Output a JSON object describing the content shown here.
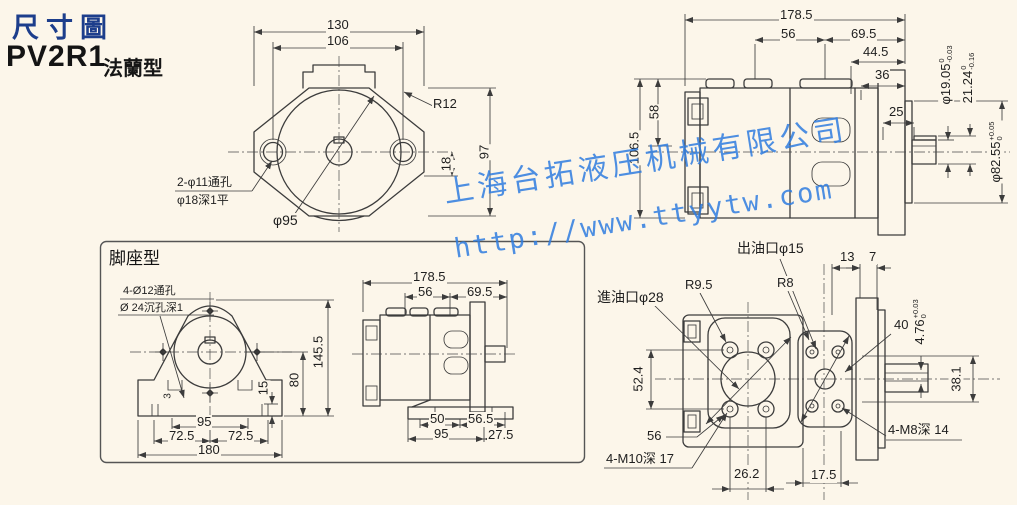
{
  "header": {
    "title": "尺寸圖",
    "model": "PV2R1",
    "variant": "法蘭型"
  },
  "watermark": {
    "company": "上海台拓液压机械有限公司",
    "url": "http://www.ttyytw.com",
    "color": "#2f7de0"
  },
  "colors": {
    "accent_navy": "#1d3e8c",
    "watermark_blue": "#2f7de0",
    "line": "#3c3c3c",
    "background": "#fcf6ea"
  },
  "flange_front": {
    "d130": "130",
    "d106": "106",
    "r12": "R12",
    "d97": "97",
    "d18": "18",
    "note1": "2-φ11通孔",
    "note2": "φ18深1平",
    "d95": "φ95"
  },
  "flange_side": {
    "d178": "178.5",
    "d56": "56",
    "d69": "69.5",
    "d44": "44.5",
    "d36": "36",
    "d25": "25",
    "d106": "106.5",
    "d58": "58",
    "shaft": {
      "v": "φ19.05",
      "t": "0",
      "b": "-0.03"
    },
    "key": {
      "v": "21.24",
      "t": "0",
      "b": "-0.16"
    },
    "spigot": {
      "v": "φ82.55",
      "t": "+0.05",
      "b": "0"
    }
  },
  "foot": {
    "label": "脚座型",
    "front": {
      "note1": "4-Ø12通孔",
      "note2": "Ø 24沉孔深1",
      "d145": "145.5",
      "d80": "80",
      "d15": "15",
      "d3": "3",
      "d95": "95",
      "d72l": "72.5",
      "d72r": "72.5",
      "d180": "180"
    },
    "side": {
      "d178": "178.5",
      "d56": "56",
      "d69": "69.5",
      "d50": "50",
      "d56_5": "56.5",
      "d95": "95",
      "d27": "27.5"
    }
  },
  "ports": {
    "outlet": "出油口φ15",
    "inlet": "進油口φ28",
    "r95": "R9.5",
    "r8": "R8",
    "d52": "52.4",
    "d56": "56",
    "m10": "4-M10深 17",
    "d26": "26.2",
    "d17": "17.5",
    "d13": "13",
    "d7": "7",
    "d40": "40",
    "keyw": {
      "v": "4.76",
      "t": "+0.03",
      "b": "0"
    },
    "d38": "38.1",
    "m8": "4-M8深 14"
  }
}
